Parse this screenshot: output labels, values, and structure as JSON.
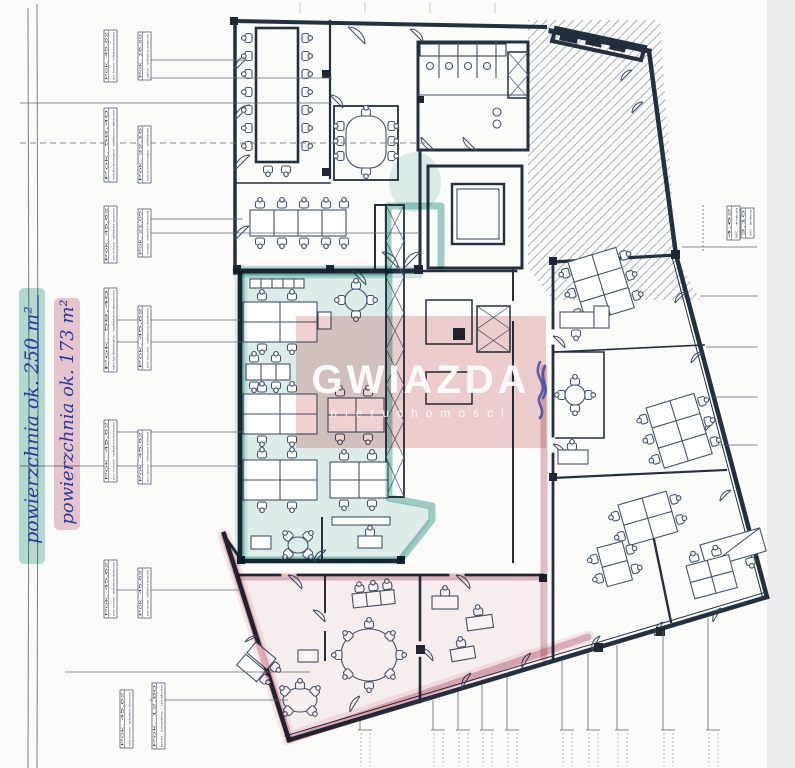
{
  "annotations": {
    "area_teal": "powierzchnia ok. 250 m²",
    "area_pink": "powierzchnia ok. 173 m²"
  },
  "watermark": {
    "title": "GWIAZDA",
    "subtitle": "nieruchomości"
  },
  "colors": {
    "teal_marker": "#3f9890",
    "pink_marker": "#c67a8f",
    "ink_blue": "#2b3a9c",
    "wall_ink": "#25303f",
    "watermark_pink": "#eec9c9",
    "paper": "#fbfbfa",
    "scan_strip": "#ececef"
  },
  "tags": {
    "types": {
      "office": {
        "c1": "Pok. 45,62",
        "c2": "pow. biurowa · wykładzina dywanowa"
      },
      "conf": {
        "c1": "Pok. 58,40",
        "c2": "sala konferencyjna · wykładzina dywanowa"
      },
      "conf2": {
        "c1": "Pok. 32,16",
        "c2": "sala konferencyjna · wykładzina"
      },
      "gab": {
        "c1": "Pok. 16,20",
        "c2": "gabinet · wykładzina dywanowa"
      },
      "ref": {
        "c1": "Pok. 21,05",
        "c2": "recepcja · wykładzina dywanowa"
      },
      "social": {
        "c1": "Pok. 12,80",
        "c2": "pom. socjalne · terakota"
      },
      "wc": {
        "c1": "4,62",
        "c2": "WC · terakota"
      },
      "wc2": {
        "c1": "3,10",
        "c2": "WC · terakota"
      }
    }
  }
}
